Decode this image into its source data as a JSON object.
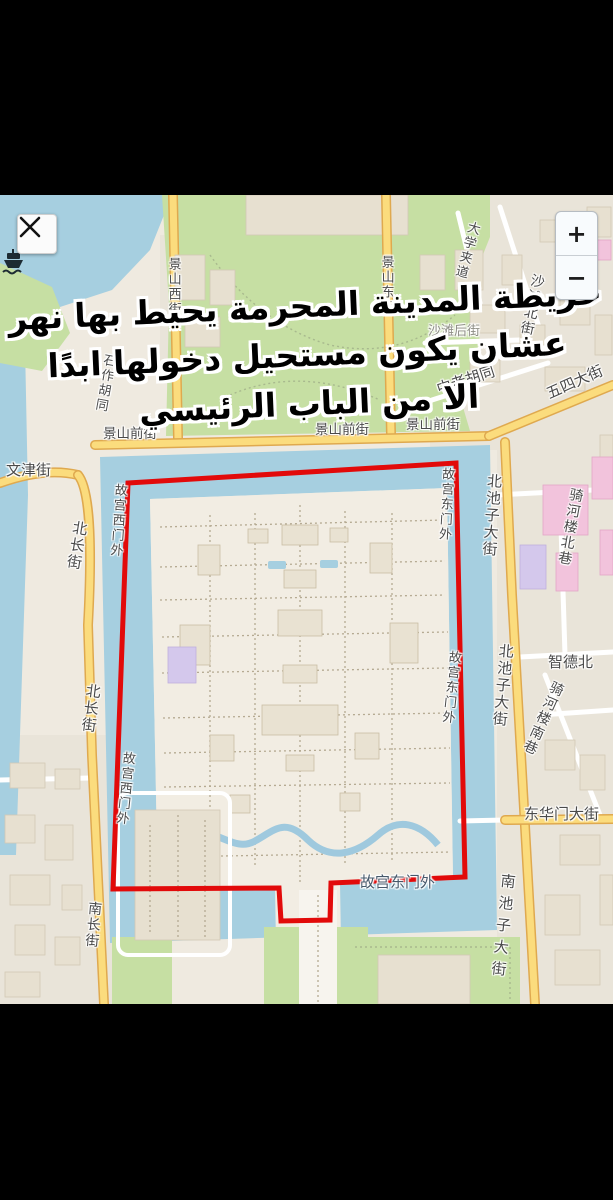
{
  "caption": {
    "line1": "خريطة المدينة المحرمة يحيط بها نهر",
    "line2": "عشان يكون مستحيل دخولها ابدًا",
    "line3": "الا من الباب الرئيسي",
    "text_color": "#000000",
    "outline_color": "#ffffff"
  },
  "controls": {
    "close": {
      "icon": "close-x"
    },
    "zoom_in": {
      "label": "+"
    },
    "zoom_out": {
      "label": "−"
    }
  },
  "icons": {
    "ferry_marker": "ferry-boat"
  },
  "map": {
    "annotation": {
      "shape": "hand-drawn boundary around Forbidden City with gate notch at bottom",
      "color": "#e20a0a"
    },
    "palette": {
      "water": "#a6cfe0",
      "park_green": "#c6dfa3",
      "road_yellow": "#fbdc7d",
      "map_base": "#efeae0",
      "letterbox": "#000000"
    },
    "labels": {
      "jingshan_front_1": "景山前街",
      "jingshan_front_2": "景山前街",
      "jingshan_front_3": "景山前街",
      "wenjin_street": "文津街",
      "shizuo_hutong": "石作胡同",
      "jingshan_west_street": "景山西街",
      "jingshan_east_street": "景山东街",
      "daxue_jiadao": "大学夹道",
      "shatan_north_street": "沙滩北街",
      "shatan_back_street": "沙滩后街",
      "zhonglao_hutong": "中老胡同",
      "wusi_street": "五四大街",
      "beichang_street_1": "北长街",
      "beichang_street_2": "北长街",
      "gugong_west_gate_1": "故宫西门外",
      "gugong_west_gate_2": "故宫西门外",
      "gugong_east_gate_1": "故宫东门外",
      "gugong_east_gate_2": "故宫东门外",
      "gugong_east_gate_3": "故宫东门外",
      "beichizi_avenue_1": "北池子大街",
      "beichizi_avenue_2": "北池子大街",
      "qihelou_north_lane": "骑河楼北巷",
      "zhide_north": "智德北",
      "qihelou_south_lane": "骑河楼南巷",
      "donghuamen_avenue": "东华门大街",
      "nanchizi_avenue": "南池子大街",
      "nanchang_street": "南长街"
    }
  }
}
